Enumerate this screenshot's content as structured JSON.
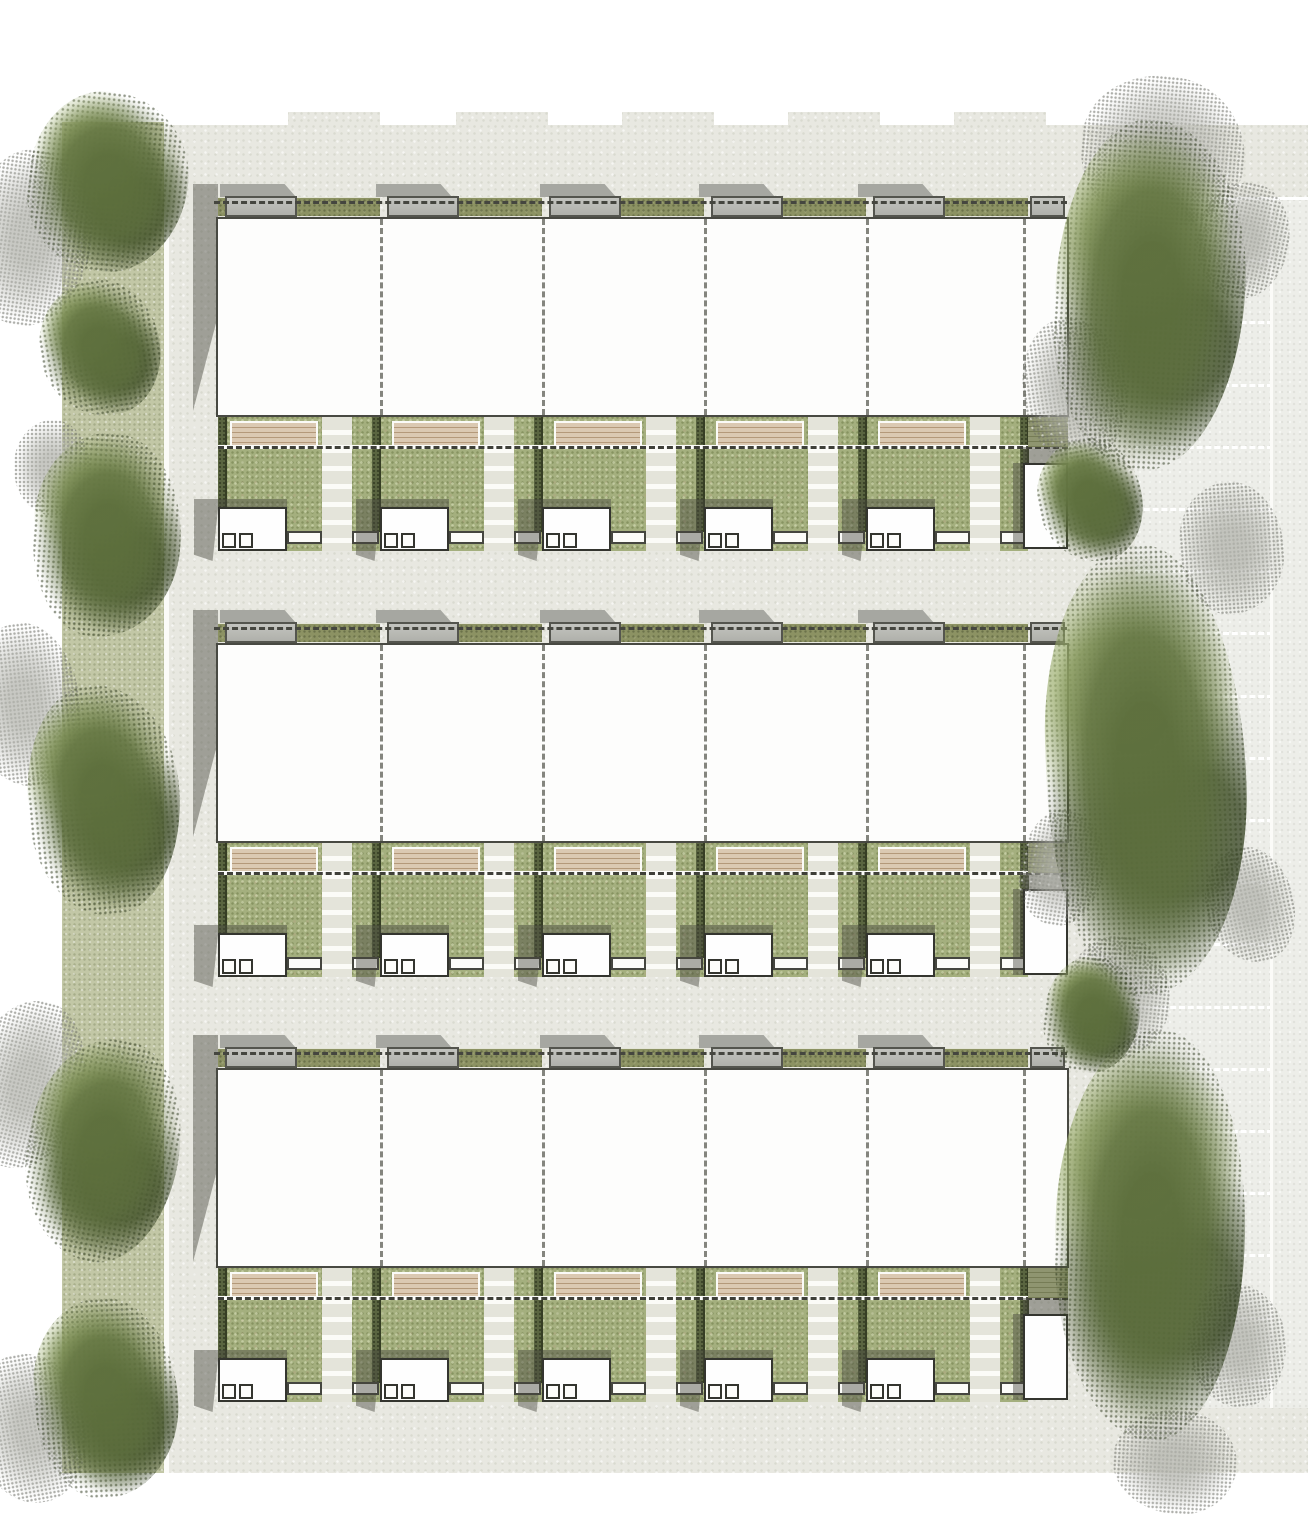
{
  "canvas": {
    "w": 1308,
    "h": 1535
  },
  "palette": {
    "paper": "#e8e8e1",
    "margin_white": "#ffffff",
    "verge_green": "#c2c7a6",
    "parapet_gray": "#a6a7a1",
    "shadow_gray": "#8f908a",
    "rooflight_gray": "#b9bab4",
    "green_roof_olive": "#8c9263",
    "roof_white": "#fdfdfc",
    "outline_dark": "#34352f",
    "boundary_dash_gray": "#84857e",
    "ridge_dash_dark": "#45463f",
    "grass_green": "#a4af7e",
    "hedge_dark_green": "#5a6540",
    "deck_timber": "#dbc9b2",
    "path_pale": "#e4e4da",
    "parking_pale": "#edeee9",
    "tree_green": "#5c6e3c",
    "tree_gray": "#b2b3ac"
  },
  "paper": {
    "x": 167,
    "y": 125,
    "w": 1141,
    "h": 1348,
    "notches": {
      "y": 112,
      "h": 13,
      "w": 92,
      "xs": [
        288,
        456,
        622,
        788,
        954
      ]
    }
  },
  "verge": {
    "x": 62,
    "y": 122,
    "w": 103,
    "h": 1351,
    "edge_line": {
      "x": 164,
      "w": 5
    }
  },
  "parking": {
    "x": 1135,
    "y": 197,
    "w": 173,
    "h": 1211,
    "bay_pitch": 62.2,
    "bay_count": 20,
    "divider_w": 138,
    "vline_x": 1270,
    "vline_w": 3
  },
  "terrace": {
    "unit_count": 5,
    "unit_xs": [
      218,
      380,
      542,
      704,
      866
    ],
    "roof": {
      "x": 216,
      "w": 853,
      "h": 200
    },
    "dividers": [
      380,
      542,
      704,
      866,
      1023
    ],
    "parapet_steps": {
      "xs": [
        220,
        376,
        540,
        699,
        858
      ],
      "w": 76,
      "h": 13,
      "dy": -33
    },
    "sliver": {
      "x": 218,
      "dy": -20,
      "w": 7,
      "h": 19
    },
    "rooflight": {
      "dx": 7,
      "w": 72,
      "dy": -21,
      "h": 21
    },
    "olive_strip": {
      "dx": 79,
      "dy": -20,
      "h": 19,
      "right_limit": 1028
    },
    "endbay_rooflight": {
      "x": 1030,
      "w": 35,
      "dy": -21,
      "h": 21
    },
    "ridge_dash": {
      "x": 214,
      "w": 853,
      "dy": -16
    },
    "garden": {
      "x": 218,
      "w": 810,
      "dy": 200,
      "h": 134
    },
    "hedges": {
      "xs": [
        218,
        372,
        534,
        696,
        858,
        1020
      ],
      "w": 9,
      "dy": 200,
      "h": 115
    },
    "deck": {
      "dx": 12,
      "w": 88,
      "dy": 204,
      "h": 27
    },
    "path": {
      "dx": 104,
      "w": 30,
      "dy": 200,
      "h": 134
    },
    "garden_dash": {
      "x": 218,
      "w": 850,
      "dy": 228
    },
    "shed": {
      "dx": 0,
      "w": 69,
      "dy": 290,
      "h": 44
    },
    "shed_shadow": {
      "dx": -24,
      "w": 93,
      "dy": 282,
      "h": 62
    },
    "skylights": {
      "dxs": [
        4,
        21
      ],
      "w": 14,
      "h": 15,
      "dy": 316
    },
    "paved_steps": [
      {
        "dx": 69,
        "w": 35
      },
      {
        "dx": 134,
        "w": 27
      }
    ],
    "paved_step_dy": 314,
    "paved_step_h": 13,
    "endbay": {
      "shade_deck": {
        "x": 1028,
        "w": 40,
        "dy": 200,
        "h": 30
      },
      "shadow_band": {
        "x": 1023,
        "w": 45,
        "dy": 230,
        "h": 16
      },
      "yard": {
        "x": 1023,
        "w": 45,
        "dy": 246,
        "h": 86
      },
      "side_shadow": {
        "x": 1013,
        "w": 10,
        "dy": 246,
        "h": 86
      }
    },
    "block_shadow": {
      "x": 193,
      "w": 25,
      "dy": -33,
      "h": 227
    }
  },
  "blocks": [
    {
      "name": "terrace-block-1",
      "roof_top": 217
    },
    {
      "name": "terrace-block-2",
      "roof_top": 643
    },
    {
      "name": "terrace-block-3",
      "roof_top": 1068
    }
  ],
  "trees": {
    "gray": [
      {
        "cx": 30,
        "cy": 238,
        "rx": 62,
        "ry": 88,
        "rot": 8
      },
      {
        "cx": 24,
        "cy": 705,
        "rx": 56,
        "ry": 82,
        "rot": -6
      },
      {
        "cx": 28,
        "cy": 1085,
        "rx": 56,
        "ry": 85,
        "rot": 14
      },
      {
        "cx": 32,
        "cy": 1428,
        "rx": 55,
        "ry": 75,
        "rot": -10
      },
      {
        "cx": 52,
        "cy": 468,
        "rx": 38,
        "ry": 48,
        "rot": 0
      },
      {
        "cx": 1163,
        "cy": 152,
        "rx": 82,
        "ry": 76,
        "rot": 5
      },
      {
        "cx": 1075,
        "cy": 390,
        "rx": 52,
        "ry": 72,
        "rot": -8
      },
      {
        "cx": 1243,
        "cy": 240,
        "rx": 46,
        "ry": 58,
        "rot": 12
      },
      {
        "cx": 1232,
        "cy": 548,
        "rx": 52,
        "ry": 66,
        "rot": -4
      },
      {
        "cx": 1062,
        "cy": 868,
        "rx": 42,
        "ry": 58,
        "rot": 9
      },
      {
        "cx": 1250,
        "cy": 905,
        "rx": 44,
        "ry": 58,
        "rot": -12
      },
      {
        "cx": 1118,
        "cy": 998,
        "rx": 52,
        "ry": 62,
        "rot": 6
      },
      {
        "cx": 1238,
        "cy": 1345,
        "rx": 48,
        "ry": 62,
        "rot": -7
      },
      {
        "cx": 1175,
        "cy": 1462,
        "rx": 62,
        "ry": 52,
        "rot": 3
      }
    ],
    "green": [
      {
        "cx": 108,
        "cy": 182,
        "rx": 80,
        "ry": 90,
        "rot": 6
      },
      {
        "cx": 100,
        "cy": 348,
        "rx": 60,
        "ry": 68,
        "rot": -9
      },
      {
        "cx": 107,
        "cy": 535,
        "rx": 74,
        "ry": 102,
        "rot": 4
      },
      {
        "cx": 104,
        "cy": 800,
        "rx": 76,
        "ry": 115,
        "rot": -5
      },
      {
        "cx": 103,
        "cy": 1150,
        "rx": 76,
        "ry": 112,
        "rot": 11
      },
      {
        "cx": 106,
        "cy": 1398,
        "rx": 72,
        "ry": 100,
        "rot": -3
      },
      {
        "cx": 1150,
        "cy": 295,
        "rx": 95,
        "ry": 175,
        "rot": 3
      },
      {
        "cx": 1090,
        "cy": 500,
        "rx": 52,
        "ry": 62,
        "rot": -11
      },
      {
        "cx": 1146,
        "cy": 770,
        "rx": 100,
        "ry": 225,
        "rot": -2
      },
      {
        "cx": 1092,
        "cy": 1015,
        "rx": 48,
        "ry": 58,
        "rot": 7
      },
      {
        "cx": 1150,
        "cy": 1235,
        "rx": 95,
        "ry": 205,
        "rot": 2
      }
    ],
    "radii": [
      "46% 54% 50% 50% / 52% 48% 55% 45%",
      "52% 48% 45% 55% / 48% 52% 50% 50%",
      "50% 50% 55% 45% / 45% 55% 48% 52%"
    ]
  }
}
